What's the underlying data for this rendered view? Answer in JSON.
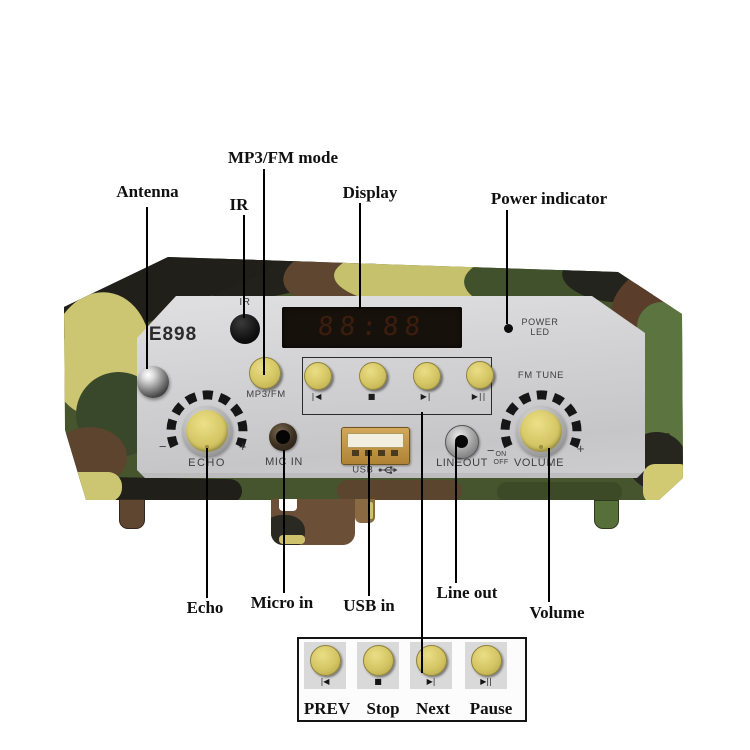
{
  "annotations": {
    "top": {
      "mp3fm_mode": "MP3/FM mode",
      "antenna": "Antenna",
      "ir": "IR",
      "display": "Display",
      "power_indicator": "Power indicator"
    },
    "bottom": {
      "echo": "Echo",
      "micro_in": "Micro in",
      "usb_in": "USB in",
      "line_out": "Line out",
      "volume": "Volume"
    }
  },
  "device": {
    "model": "E898",
    "ir_label": "IR",
    "power_led_line1": "POWER",
    "power_led_line2": "LED",
    "display_ghost": "88:88",
    "mode_button_label": "MP3/FM",
    "transport": {
      "symbols": [
        "|◀",
        "■",
        "▶|",
        "▶||"
      ]
    },
    "echo": {
      "label": "ECHO",
      "minus": "−",
      "plus": "+"
    },
    "fm": {
      "label": "FM TUNE",
      "minus": "−",
      "plus": "+"
    },
    "mic_label": "MIC IN",
    "usb_label": "USB",
    "lineout_label": "LINEOUT",
    "power_switch_line1": "ON",
    "power_switch_line2": "OFF",
    "volume_label": "VOLUME"
  },
  "legend": {
    "items": [
      {
        "symbol": "|◀",
        "label": "PREV"
      },
      {
        "symbol": "■",
        "label": "Stop"
      },
      {
        "symbol": "▶|",
        "label": "Next"
      },
      {
        "symbol": "▶||",
        "label": "Pause"
      }
    ]
  },
  "colors": {
    "button_yellow": "#d4c563",
    "panel_silver": "#cfcfd1",
    "camo_green": "#46552d",
    "camo_yellow": "#ccc672",
    "camo_brown": "#5c442f",
    "camo_black": "#201f1a"
  }
}
